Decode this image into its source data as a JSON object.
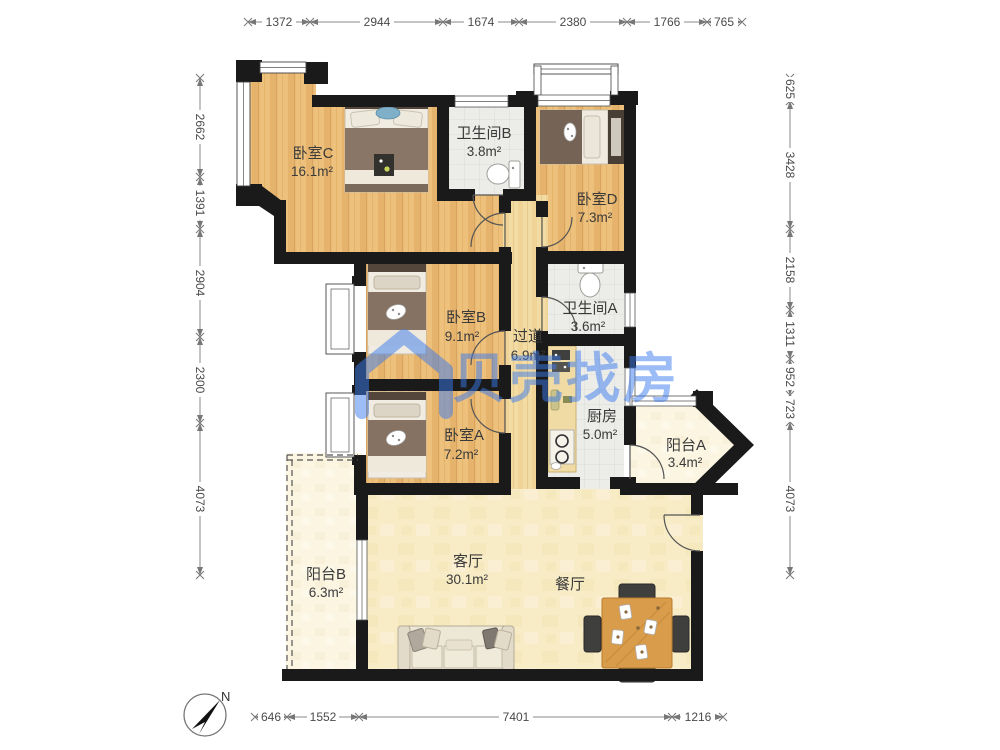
{
  "watermark": {
    "text": "贝壳找房",
    "color": "#3A7BEE"
  },
  "compass": {
    "label": "N"
  },
  "rooms": [
    {
      "name": "卧室C",
      "area": "16.1m²"
    },
    {
      "name": "卫生间B",
      "area": "3.8m²"
    },
    {
      "name": "卧室D",
      "area": "7.3m²"
    },
    {
      "name": "卧室B",
      "area": "9.1m²"
    },
    {
      "name": "过道",
      "area": "6.9m²"
    },
    {
      "name": "卫生间A",
      "area": "3.6m²"
    },
    {
      "name": "卧室A",
      "area": "7.2m²"
    },
    {
      "name": "厨房",
      "area": "5.0m²"
    },
    {
      "name": "阳台A",
      "area": "3.4m²"
    },
    {
      "name": "客厅",
      "area": "30.1m²"
    },
    {
      "name": "餐厅"
    },
    {
      "name": "阳台B",
      "area": "6.3m²"
    }
  ],
  "dimensions": {
    "top": [
      "1372",
      "2944",
      "1674",
      "2380",
      "1766",
      "765"
    ],
    "bottom": [
      "646",
      "1552",
      "7401",
      "1216"
    ],
    "left": [
      "2662",
      "1391",
      "2904",
      "2300",
      "4073"
    ],
    "right": [
      "625",
      "3428",
      "2158",
      "1311",
      "952",
      "723",
      "4073"
    ]
  },
  "colors": {
    "wall": "#1A1A1A",
    "wood_floor": "#EDC07C",
    "tile_floor": "#ECECE9",
    "living_floor": "#F8ECC6",
    "hall_floor": "#F3DCA3",
    "balcony_floor": "#FBF5E2",
    "watermark_blue": "#3A7BEE"
  }
}
